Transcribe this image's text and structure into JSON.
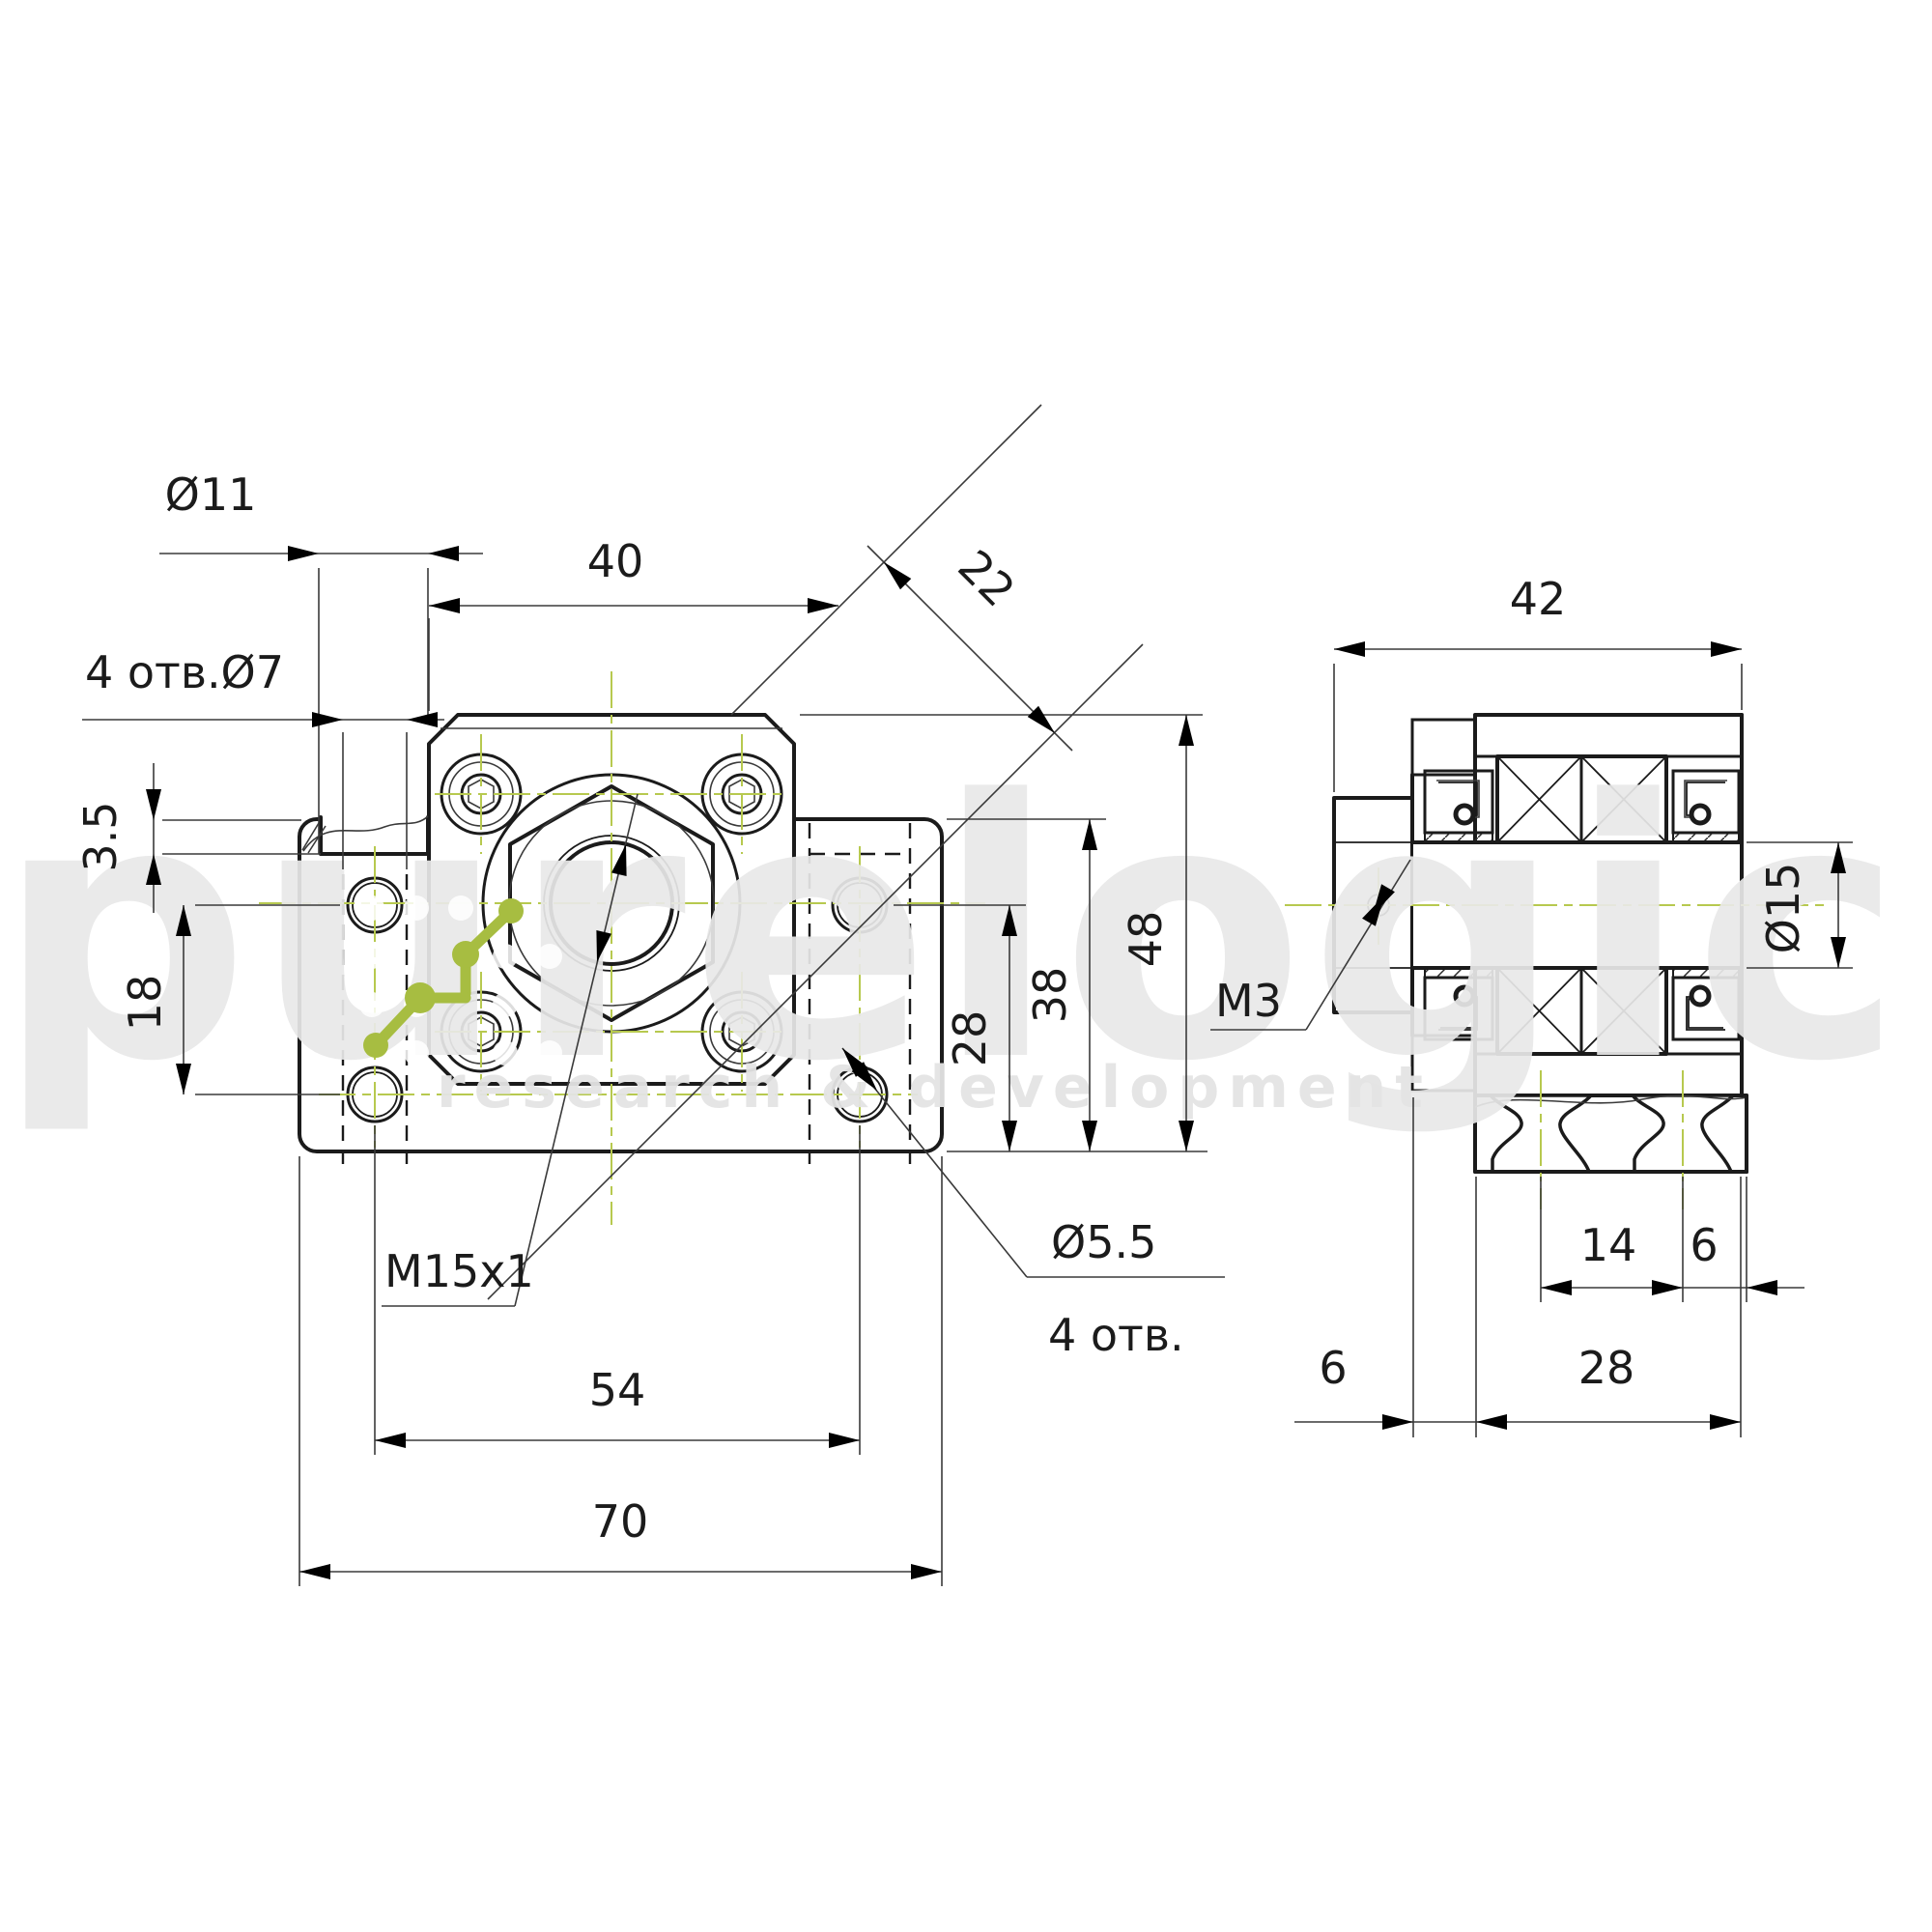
{
  "watermark": {
    "brand": "purelogic",
    "subtitle": "research & development"
  },
  "colors": {
    "centerline": "#b7c94f",
    "logo": "#a7bd41",
    "ink": "#1b1b1b",
    "watermark_gray": "#e9e9e9"
  },
  "front_view": {
    "dims": {
      "counterbore": "Ø11",
      "base_holes": "4 отв.Ø7",
      "flange_width": "40",
      "hex_flats": "22",
      "step_depth": "3.5",
      "hole_pitch_v": "18",
      "h28": "28",
      "h38": "38",
      "h48": "48",
      "thread": "M15x1",
      "hole_pitch_h": "54",
      "base_width": "70",
      "small_holes": "Ø5.5",
      "small_holes_count": "4 отв."
    }
  },
  "side_view": {
    "dims": {
      "total_depth": "42",
      "shaft_bore": "Ø15",
      "set_screw": "M3",
      "hole_pitch": "14",
      "edge_offset": "6",
      "collar_thickness": "6",
      "body_depth": "28"
    }
  }
}
